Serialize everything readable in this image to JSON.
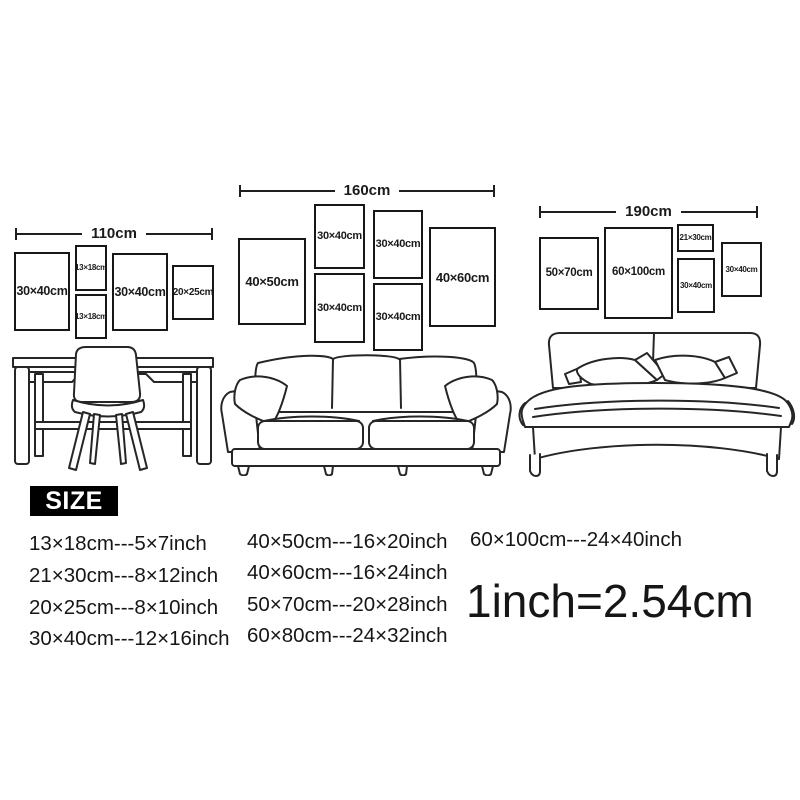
{
  "colors": {
    "ink": "#1a1a1a",
    "frame_border": "#171717",
    "badge_bg": "#000000",
    "badge_text": "#ffffff",
    "background": "#ffffff"
  },
  "scenes": [
    {
      "width_label": "110cm",
      "furniture_icon": "desk-and-chair-illustration",
      "frames": [
        "30×40cm",
        "13×18cm",
        "13×18cm",
        "30×40cm",
        "20×25cm"
      ]
    },
    {
      "width_label": "160cm",
      "furniture_icon": "sofa-illustration",
      "frames": [
        "40×50cm",
        "30×40cm",
        "30×40cm",
        "30×40cm",
        "30×40cm",
        "40×60cm"
      ]
    },
    {
      "width_label": "190cm",
      "furniture_icon": "bed-illustration",
      "frames": [
        "50×70cm",
        "60×100cm",
        "21×30cm",
        "30×40cm",
        "30×40cm"
      ]
    }
  ],
  "size_section": {
    "heading": "SIZE",
    "columns": [
      [
        "13×18cm---5×7inch",
        "21×30cm---8×12inch",
        "20×25cm---8×10inch",
        "30×40cm---12×16inch"
      ],
      [
        "40×50cm---16×20inch",
        "40×60cm---16×24inch",
        "50×70cm---20×28inch",
        "60×80cm---24×32inch"
      ],
      [
        "60×100cm---24×40inch"
      ]
    ],
    "conversion_note": "1inch=2.54cm"
  }
}
